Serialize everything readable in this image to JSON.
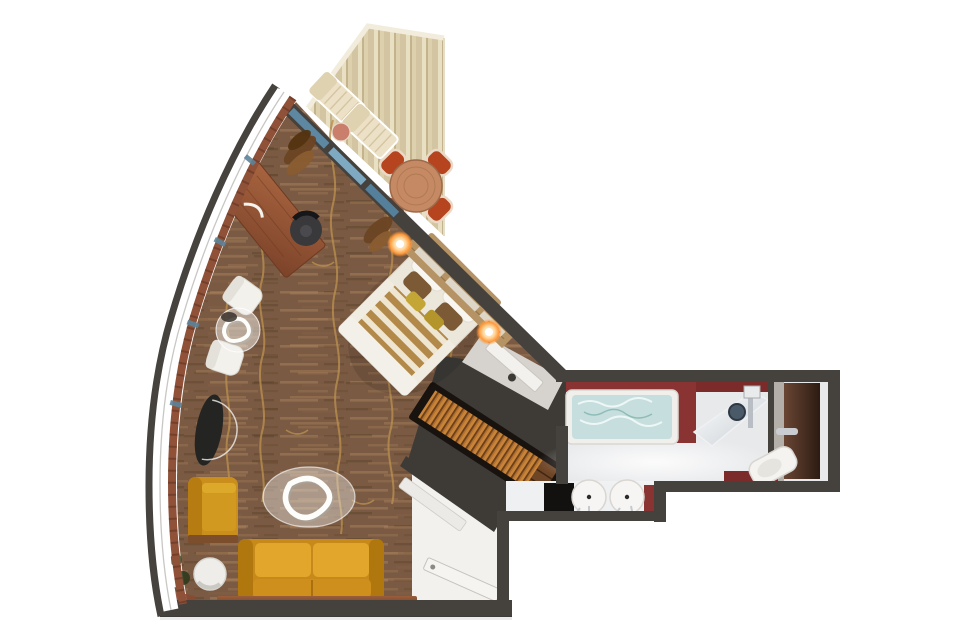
{
  "scene": {
    "type": "cabin-suite-floor-plan",
    "rooms": [
      {
        "name": "balcony",
        "items": [
          "sun-lounger",
          "sun-lounger",
          "side-table",
          "dining-table",
          "dining-chair",
          "dining-chair",
          "dining-chair",
          "dining-chair"
        ]
      },
      {
        "name": "living-sleeping-area",
        "items": [
          "desk",
          "desk-chair",
          "desk-lamp",
          "curtains",
          "lounge-chair",
          "lounge-chair",
          "round-glass-table",
          "console-table",
          "armchair",
          "oval-glass-coffee-table",
          "sofa",
          "side-table",
          "low-cabinet",
          "double-bed",
          "bedside-lamp",
          "bedside-lamp",
          "wardrobe",
          "plant"
        ]
      },
      {
        "name": "entry",
        "items": [
          "entrance-door",
          "interior-door"
        ]
      },
      {
        "name": "bathroom",
        "items": [
          "jetted-tub",
          "shower",
          "shower-head",
          "toilet",
          "toilet-door",
          "double-sinks",
          "vanity-counter",
          "black-cabinet"
        ]
      }
    ]
  },
  "colors": {
    "wall": "#45413d",
    "floor_wood": "#7a5a43",
    "floor_gold": "#b98f4e",
    "balcony_deck": "#decfac",
    "glass_blue": "#5e88a2",
    "glass_blue_light": "#7fa9c0",
    "sill": "#8f5138",
    "headboard": "#b59364",
    "duvet_stripe": "#b3894a",
    "linen": "#f2efe8",
    "sofa": "#c8891b",
    "seat_cushion": "#e2a62c",
    "armchair": "#c98e1c",
    "desk_wood": "#9a5a3c",
    "wardrobe_clothes": "#b5722f",
    "entry_floor": "#f2f1ee",
    "bath_floor": "#e8e9eb",
    "bath_red": "#8a3333",
    "tub_water": "#c6dedd",
    "toilet_door_brown": "#5a3a2c",
    "porcelain": "#f6f5f3",
    "black_cabinet": "#121110",
    "lamp_glow": "#ff9a3c",
    "dining_chair_red": "#b5441f",
    "table_wood": "#c58a64",
    "lounger_beige": "#ece1c6"
  }
}
